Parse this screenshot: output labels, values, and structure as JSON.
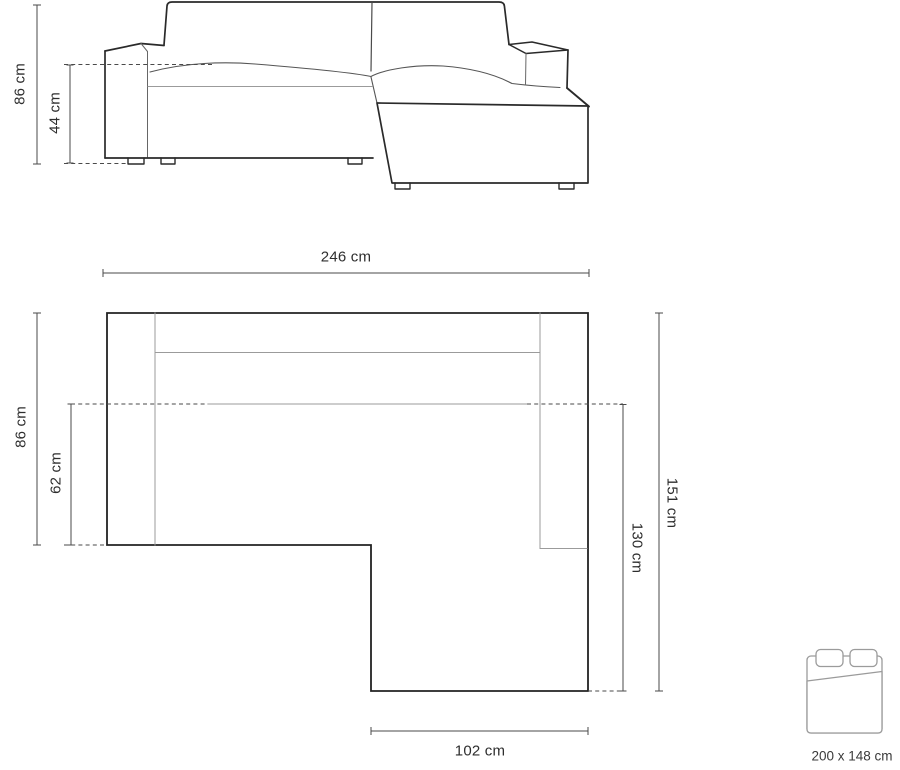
{
  "diagram_title": "corner-sofa-dimensions",
  "front_view": {
    "total_height_label": "86 cm",
    "seat_height_label": "44 cm"
  },
  "top_view": {
    "total_width_label": "246 cm",
    "body_depth_label": "86 cm",
    "seat_depth_label": "62 cm",
    "total_length_label": "151 cm",
    "chaise_length_label": "130 cm",
    "chaise_width_label": "102 cm"
  },
  "sleeping_area": {
    "size_label": "200 x 148 cm"
  },
  "colors": {
    "background": "#ffffff",
    "outline": "#2a2a2a",
    "thin_line": "#9b9b9b",
    "medium_line": "#555555",
    "dimension_line": "#4a4a4a",
    "text": "#2e2e2e",
    "bed_icon_line": "#9b9b9b"
  }
}
